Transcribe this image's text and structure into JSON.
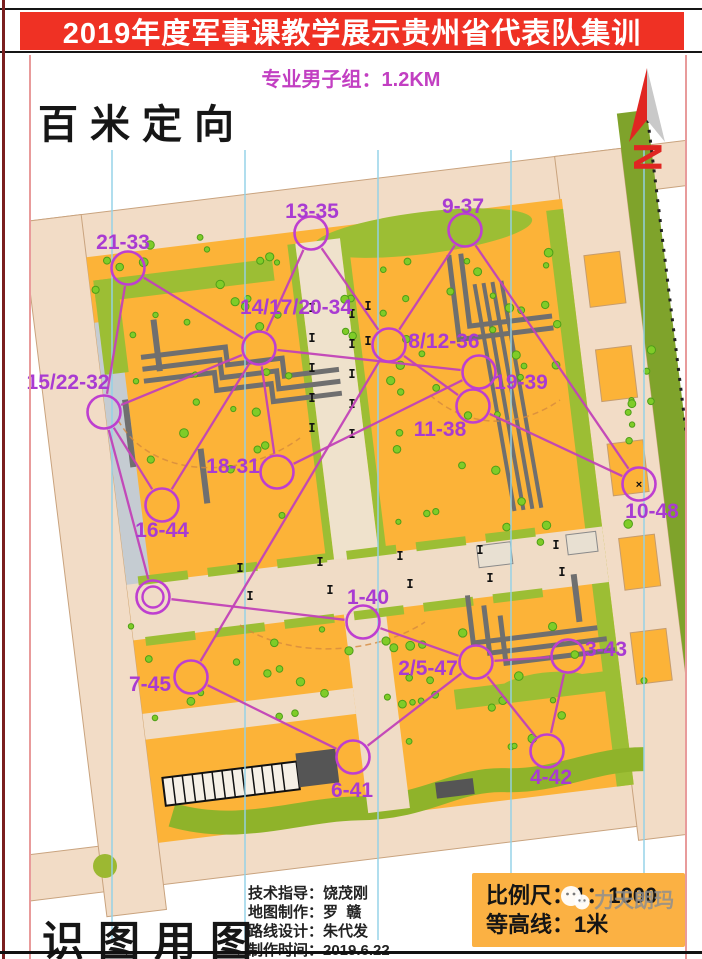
{
  "header": {
    "title": "2019年度军事课教学展示贵州省代表队集训",
    "subtitle": "专业男子组：1.2KM"
  },
  "corner_labels": {
    "top_left": "百米定向",
    "bottom_left": "识图用图"
  },
  "north_arrow": {
    "label": "N"
  },
  "credits": {
    "line1": "技术指导：饶茂刚",
    "line2": "地图制作：罗  赣",
    "line3": "路线设计：朱代发",
    "line4": "制作时间：2019.6.22"
  },
  "scale_box": {
    "scale": "比例尺：1：1000",
    "contour": "等高线：1米"
  },
  "watermark": {
    "icon": "wechat-icon",
    "text": "力天朗玛"
  },
  "colors": {
    "title_red": "#EF3124",
    "course_magenta": "#C243B8",
    "circle_magenta": "#BE3FD0",
    "label_purple": "#A93BD2",
    "open_orange": "#FCB338",
    "vegetation_green": "#9CBE34",
    "road_beige": "#F2DCC6",
    "building_gray": "#6F6F6F",
    "north_line_blue": "#93D2E8",
    "scale_box_orange": "#FBB143"
  },
  "chart_data": {
    "type": "orienteering-course-map",
    "course_length_km": 1.2,
    "scale": "1:1000",
    "contour_interval": "1米",
    "controls": [
      {
        "id": "start_finish",
        "label": "",
        "x": 153,
        "y": 597,
        "lx": 0,
        "ly": 0,
        "kind": "double"
      },
      {
        "id": "1-40",
        "label": "1-40",
        "x": 363,
        "y": 622,
        "lx": 368,
        "ly": 597,
        "kind": "control"
      },
      {
        "id": "2/5-47",
        "label": "2/5-47",
        "x": 476,
        "y": 662,
        "lx": 428,
        "ly": 668,
        "kind": "control"
      },
      {
        "id": "3-43",
        "label": "3-43",
        "x": 568,
        "y": 656,
        "lx": 606,
        "ly": 649,
        "kind": "control"
      },
      {
        "id": "4-42",
        "label": "4-42",
        "x": 547,
        "y": 751,
        "lx": 551,
        "ly": 777,
        "kind": "control"
      },
      {
        "id": "6-41",
        "label": "6-41",
        "x": 353,
        "y": 757,
        "lx": 352,
        "ly": 790,
        "kind": "control"
      },
      {
        "id": "7-45",
        "label": "7-45",
        "x": 191,
        "y": 677,
        "lx": 150,
        "ly": 684,
        "kind": "control"
      },
      {
        "id": "8/12-36",
        "label": "8/12-36",
        "x": 389,
        "y": 345,
        "lx": 444,
        "ly": 341,
        "kind": "control"
      },
      {
        "id": "9-37",
        "label": "9-37",
        "x": 465,
        "y": 230,
        "lx": 463,
        "ly": 206,
        "kind": "control"
      },
      {
        "id": "10-48",
        "label": "10-48",
        "x": 639,
        "y": 484,
        "lx": 652,
        "ly": 511,
        "kind": "control-x"
      },
      {
        "id": "11-38",
        "label": "11-38",
        "x": 473,
        "y": 406,
        "lx": 440,
        "ly": 429,
        "kind": "control"
      },
      {
        "id": "13-35",
        "label": "13-35",
        "x": 311,
        "y": 233,
        "lx": 312,
        "ly": 211,
        "kind": "control"
      },
      {
        "id": "14/17/20-34",
        "label": "14/17/20-34",
        "x": 259,
        "y": 348,
        "lx": 296,
        "ly": 307,
        "kind": "control"
      },
      {
        "id": "15/22-32",
        "label": "15/22-32",
        "x": 104,
        "y": 412,
        "lx": 68,
        "ly": 382,
        "kind": "control"
      },
      {
        "id": "16-44",
        "label": "16-44",
        "x": 162,
        "y": 505,
        "lx": 162,
        "ly": 530,
        "kind": "control"
      },
      {
        "id": "18-31",
        "label": "18-31",
        "x": 277,
        "y": 472,
        "lx": 233,
        "ly": 466,
        "kind": "control"
      },
      {
        "id": "19-39",
        "label": "19-39",
        "x": 479,
        "y": 372,
        "lx": 521,
        "ly": 382,
        "kind": "control"
      },
      {
        "id": "21-33",
        "label": "21-33",
        "x": 128,
        "y": 268,
        "lx": 123,
        "ly": 242,
        "kind": "control"
      }
    ],
    "route_sequence": [
      "start_finish",
      "1-40",
      "2/5-47",
      "3-43",
      "4-42",
      "2/5-47",
      "6-41",
      "7-45",
      "8/12-36",
      "9-37",
      "10-48",
      "11-38",
      "8/12-36",
      "13-35",
      "14/17/20-34",
      "15/22-32",
      "16-44",
      "14/17/20-34",
      "18-31",
      "19-39",
      "14/17/20-34",
      "21-33",
      "15/22-32",
      "start_finish"
    ]
  }
}
